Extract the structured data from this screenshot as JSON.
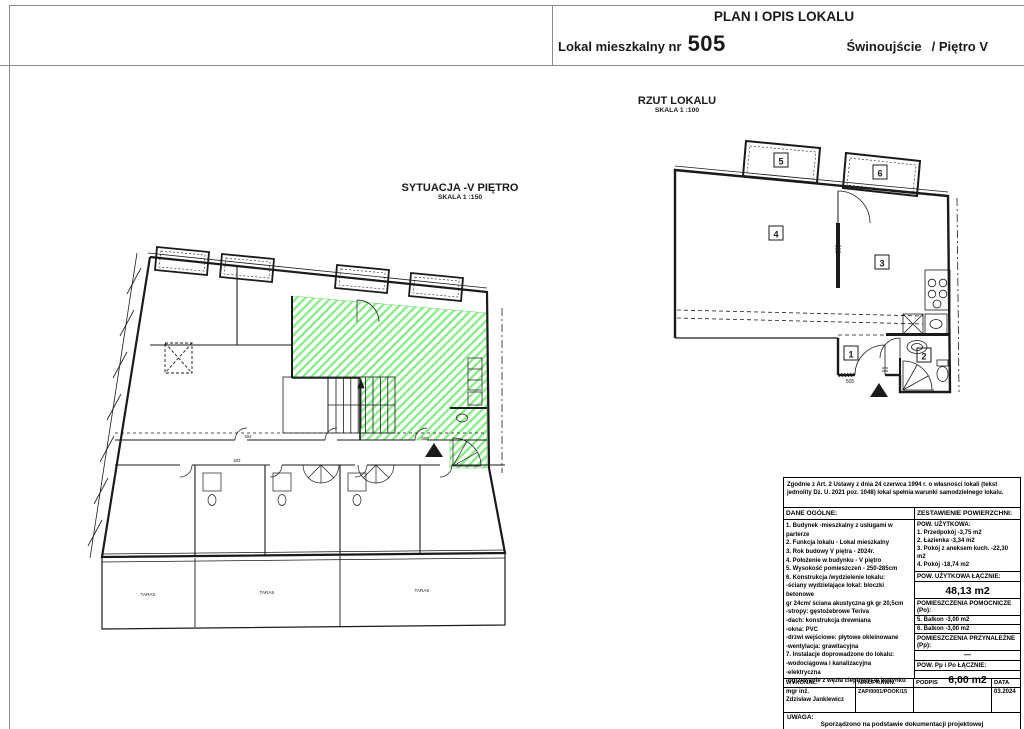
{
  "header": {
    "title": "PLAN I OPIS LOKALU",
    "unit_label_prefix": "Lokal mieszkalny nr",
    "unit_number": "505",
    "location": "Świnoujście",
    "floor": "/ Piętro V"
  },
  "situation_plan": {
    "title": "SYTUACJA -V PIĘTRO",
    "scale": "SKALA 1 :150",
    "terrace_label": "TARAS",
    "unit_label": "505",
    "corridor_labels": [
      "504",
      "503"
    ]
  },
  "unit_plan": {
    "title": "RZUT LOKALU",
    "scale": "SKALA 1 :100",
    "entrance_label": "505",
    "room_numbers": [
      "1",
      "2",
      "3",
      "4",
      "5",
      "6"
    ]
  },
  "table": {
    "legal_note": "Zgodnie z Art. 2 Ustawy z dnia 24 czerwca 1994 r. o własności lokali (tekst jednolity Dz. U. 2021 poz. 1048) lokal spełnia warunki samodzielnego lokalu.",
    "general_header": "DANE OGÓLNE:",
    "areas_header": "ZESTAWIENIE POWIERZCHNI:",
    "general_items": "1. Budynek -mieszkalny z usługami w parterze\n2. Funkcja lokalu - Lokal mieszkalny\n3. Rok budowy V piętra - 2024r.\n4. Położenie w budynku - V piętro\n5. Wysokość pomieszczeń - 250-285cm\n6. Konstrukcja /wydzielenie lokalu:\n-ściany wydzielające lokal: bloczki betonowe\ngr 24cm/ ściana akustyczna gk gr 20,5cm\n-stropy: gęstożebrowe Teriva\n-dach: konstrukcja drewniana\n-okna: PVC\n-drzwi wejściowe: płytowe okleinowane\n-wentylacja: grawitacyjna\n7. Instalacje doprowadzone do lokalu:\n-wodociągowa i kanalizacyjna\n-elektryczna\n-ogrzewanie z węzła cieplnego w budynku",
    "usable_block": "POW. UŻYTKOWA:\n1. Przedpokój -3,75 m2\n2. Łazienka -3,34 m2\n3. Pokój z aneksem kuch. -22,30 m2\n4. Pokój -18,74 m2",
    "usable_total_header": "POW. UŻYTKOWA ŁĄCZNIE:",
    "usable_total": "48,13 m2",
    "aux_header": "POMIESZCZENIA POMOCNICZE (Po):",
    "aux_item_1": "5. Balkon -3,00 m2",
    "aux_item_2": "6. Balkon -3,00 m2",
    "belong_header": "POMIESZCZENIA PRZYNALEŻNE (Pp):",
    "belong_value": "—",
    "total_header": "POW. Pp i Po ŁĄCZNIE:",
    "total_value": "6,00 m2",
    "sig_col_1": "WYKONAŁ:",
    "sig_col_2": "NR UPRAWN.",
    "sig_col_3": "PODPIS",
    "sig_col_4": "DATA",
    "executor": "mgr inż.\nZdzisław Jankiewicz",
    "license_no": "ZAP/0001/POOK/15",
    "signature_value": "",
    "date": "03.2024",
    "note_header": "UWAGA:",
    "note": "Sporządzono na podstawie dokumentacji projektowej"
  },
  "colors": {
    "highlight_green": "#8cec8c",
    "line": "#1a1a1a"
  }
}
